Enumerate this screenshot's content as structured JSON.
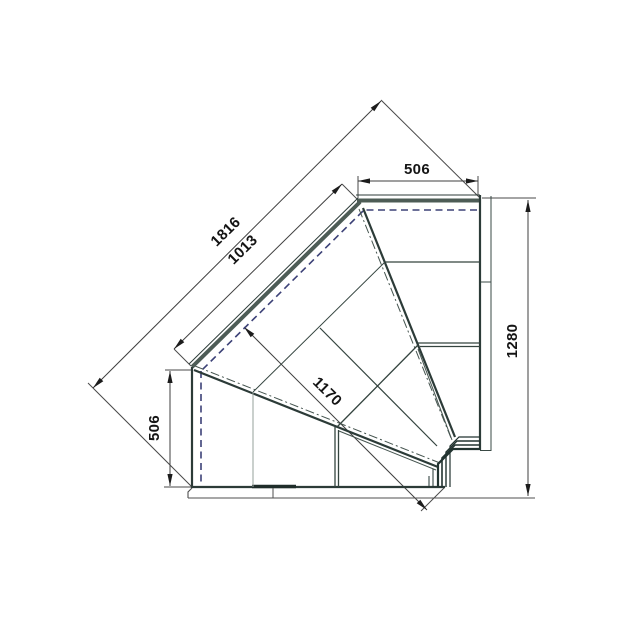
{
  "drawing": {
    "title": "Corner display counter — internal angle 90° plan view",
    "dimensions": {
      "top_width": "506",
      "right_height": "1280",
      "left_height": "506",
      "diagonal_overall": "1816",
      "diagonal_front": "1013",
      "diagonal_inner": "1170"
    },
    "colors": {
      "background": "#ffffff",
      "edge_dark": "#2c3b38",
      "edge_glass": "#4d5c56",
      "shelf_line": "#34443f",
      "faint_line": "#96a09b",
      "dimension_line": "#4a4a4a",
      "arrow": "#1c1c1c",
      "dashed_blue": "#3c4177"
    }
  }
}
